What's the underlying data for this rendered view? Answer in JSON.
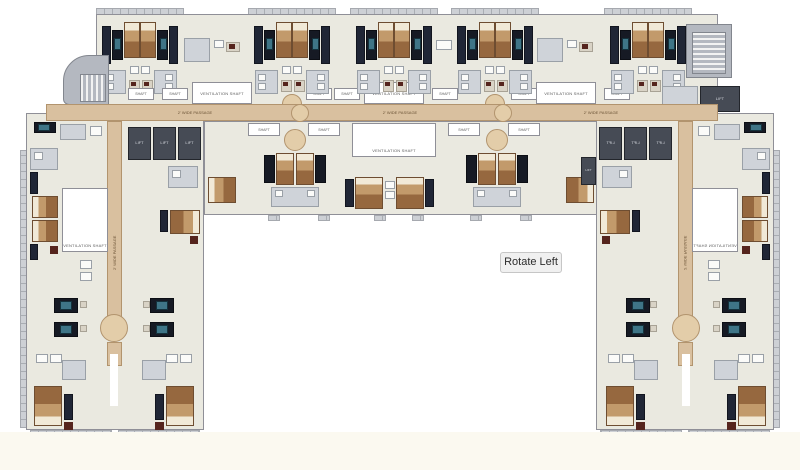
{
  "controls": {
    "rotate_left_label": "Rotate Left"
  },
  "plan": {
    "labels": {
      "ventilation_shaft": "VENTILATION SHAFT",
      "shaft": "SHAFT",
      "passage": "2' WIDE PASSAGE",
      "lift": "LIFT"
    },
    "colors": {
      "background": "#ffffff",
      "footer_band": "#fbf9f0",
      "floor": "#eae9e0",
      "wall": "#8f8f97",
      "passage_tan": "#d9c09f",
      "bed_tan": "#c29a6b",
      "wardrobe_navy": "#202636",
      "tv_screen_teal": "#3f7587",
      "lift_gray": "#464b55",
      "stove_maroon": "#55241d",
      "button_bg": "#f0f0f0",
      "button_border": "#c6c6c6",
      "button_text": "#2d2d2d"
    }
  }
}
